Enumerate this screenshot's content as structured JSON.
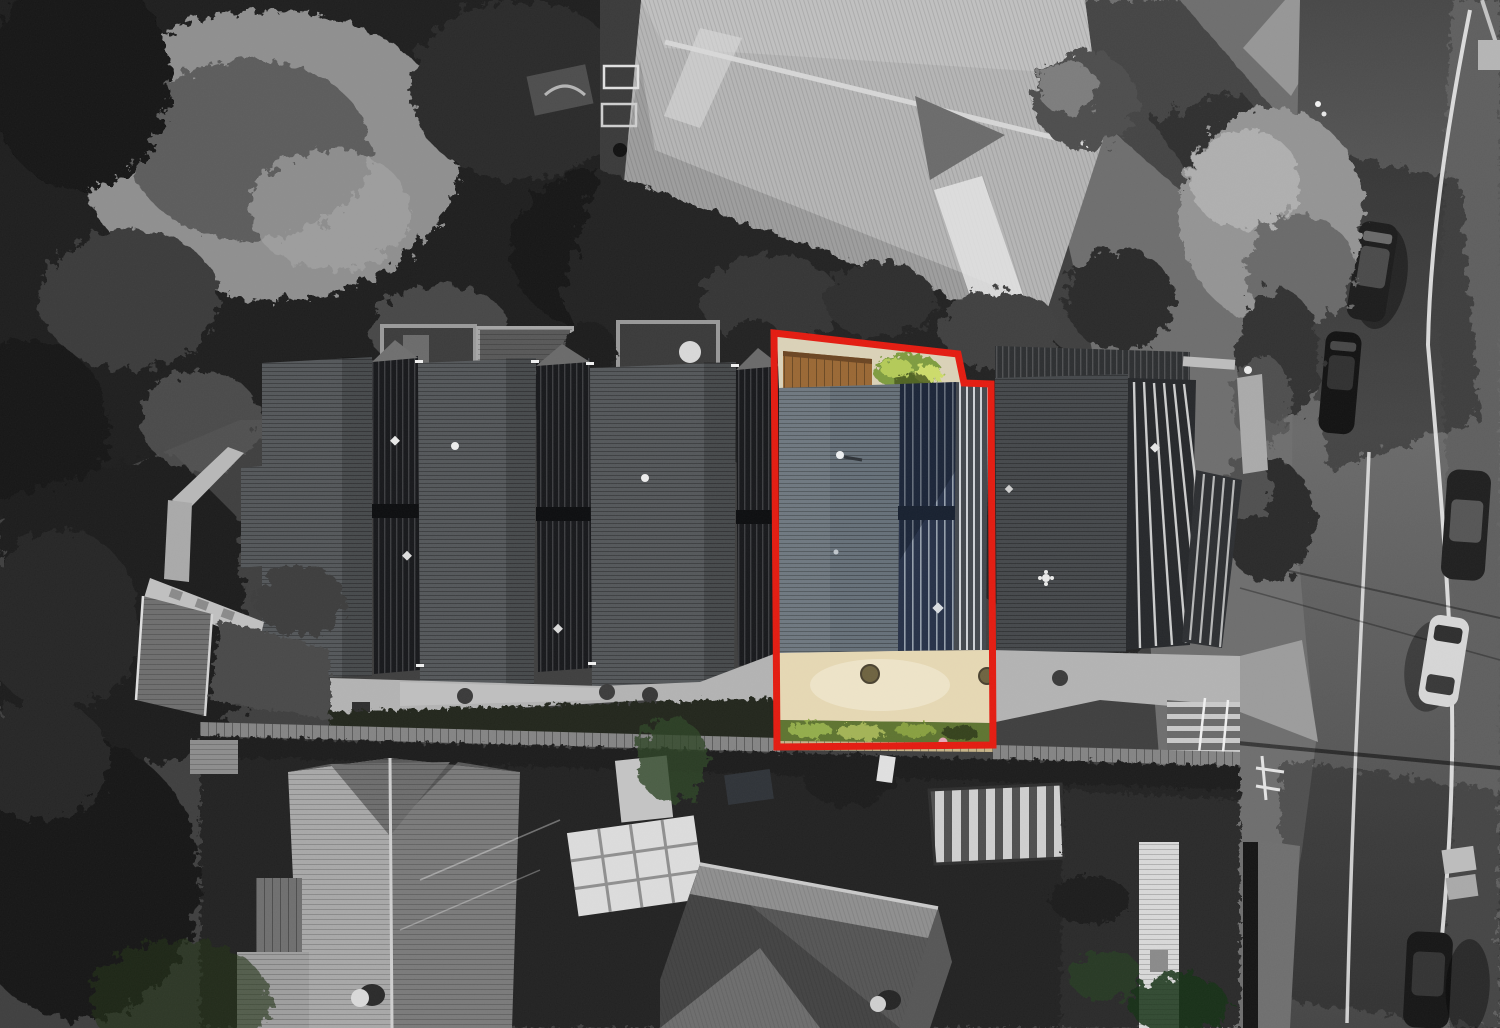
{
  "scene": {
    "kind": "aerial-drone-photo",
    "style": "grayscale photo with one property highlighted in colour inside a red boundary outline"
  },
  "palette": {
    "red_outline": "#e41b10",
    "base_ground": "#3f3f3f",
    "lawn": "#6e6e6e",
    "road": "#5a5a5a",
    "road_shadow": "#383838",
    "sidewalk": "#969696",
    "line_white": "#e9e9e9",
    "big_roof_light": "#b5b5b5",
    "big_roof_shade": "#9d9d9d",
    "gable_shadow": "#6b6b6b",
    "townhouse_roof": "#54575a",
    "townhouse_roof_right": "#45484b",
    "separator_dark": "#17181b",
    "path_concrete": "#b3b3b3",
    "boardwalk": "#848484",
    "hedge_dark": "#23261f",
    "tree_dark": "#1e1e1e",
    "canopy_light": "#949494",
    "house_roof_bright": "#a8a8a8",
    "house_roof_mid": "#7a7a7a",
    "dark_house_roof": "#434343",
    "dark_house_roof_lit": "#8f8f8f",
    "carport_light": "#cfcfcf",
    "carport_dark": "#4f4f4f",
    "fence_white": "#dcdcdc",
    "car_dark": "#1c1c1c",
    "car_white": "#d6d6d6",
    "hl_slate_roof": "#667079",
    "hl_navy_roof": "#263148",
    "hl_rib_silver": "#d9dde1",
    "hl_cream_trim": "#dbd2b8",
    "hl_wood_deck": "#9a6834",
    "hl_foliage": "#7e9c3f",
    "hl_foliage_light": "#b4ca58",
    "hl_concrete_tan": "#e6d8b4",
    "hl_concrete_tan_light": "#f0e7cd",
    "hl_drain": "#6e6340",
    "hl_grass": "#5e7430",
    "hl_grass_light": "#93ad4b",
    "hl_board_tan": "#c6b488",
    "hl_pink_person": "#e6a8b8"
  },
  "highlight": {
    "outline_points": "774,333 958,354 964,383 991,384 993,745 777,747",
    "stroke_width": 7
  },
  "counts": {
    "parked_cars": 5,
    "townhouse_units_visible": 5
  }
}
